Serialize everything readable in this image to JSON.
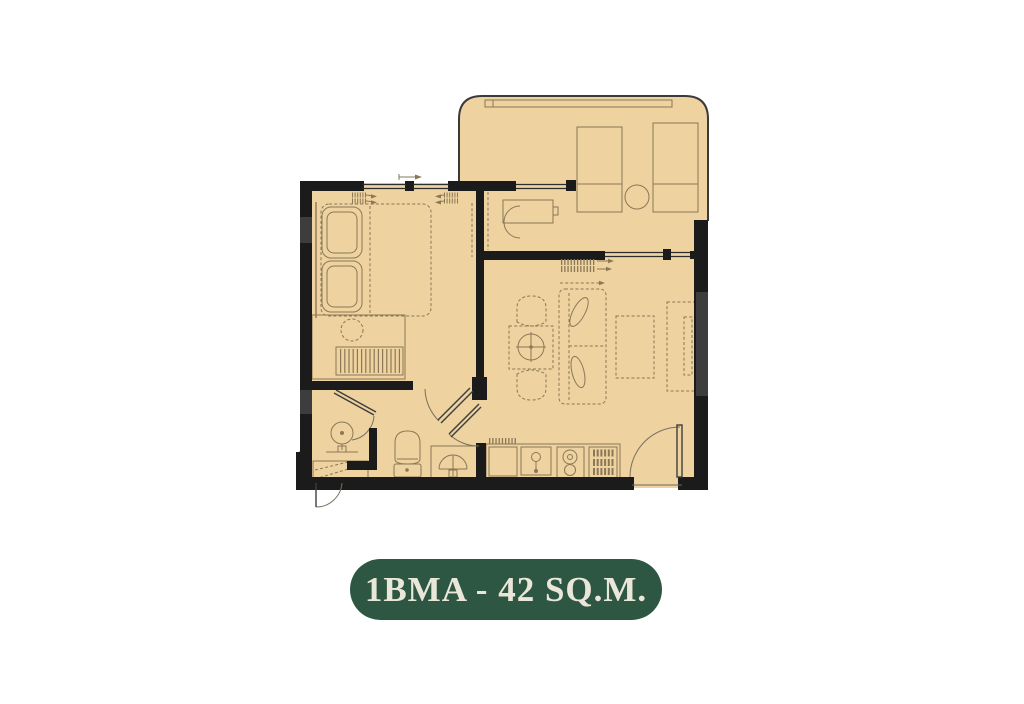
{
  "canvas": {
    "width": 1024,
    "height": 704,
    "background": "#ffffff"
  },
  "floorplan": {
    "colors": {
      "floor": "#eed2a0",
      "wall": "#1b1b1b",
      "wall-window": "#3d3d3d",
      "line": "#8a7856",
      "outline": "#3a3a3a"
    },
    "elements": [
      "balcony",
      "planter-box",
      "lounge-chair",
      "lounge-chair",
      "balcony-round-table",
      "work-desk",
      "desk-chair",
      "bedroom",
      "double-bed",
      "pillows",
      "wardrobe-hangers",
      "side-stool",
      "living-dining",
      "sofa",
      "dining-table",
      "dining-chair",
      "dining-chair",
      "coffee-table",
      "tv-console",
      "kitchen-counter",
      "kitchen-sink",
      "stove",
      "dish-rack",
      "bathroom",
      "shower",
      "toilet",
      "vanity-basin",
      "entrance-door",
      "ac-ledge"
    ]
  },
  "label": {
    "text": "1BMA - 42 SQ.M.",
    "background": "#2d5743",
    "text_color": "#eae7da"
  }
}
